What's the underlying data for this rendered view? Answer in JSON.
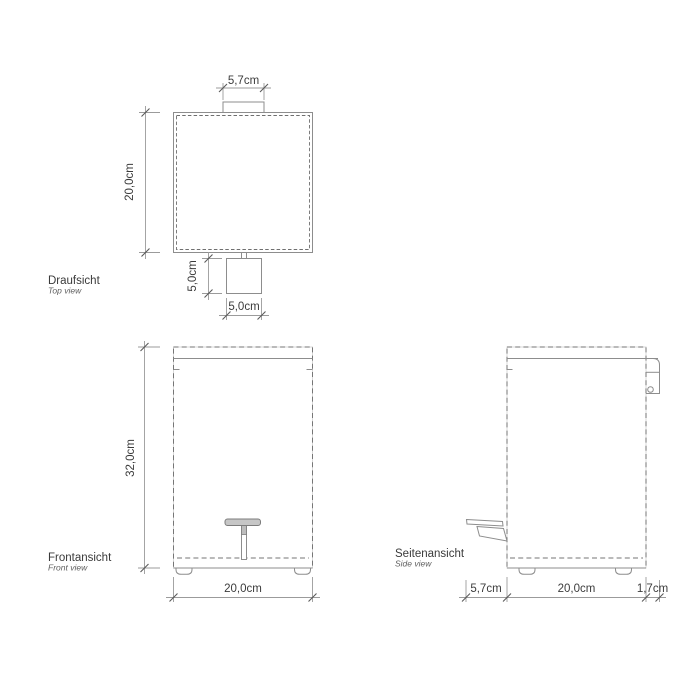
{
  "drawing": {
    "background": "#ffffff",
    "line_color": "#8d8d8d",
    "dim_line_color": "#9b9b9b",
    "text_color": "#3c3c3c",
    "pedal_fill_color": "#c6c6c6",
    "views": {
      "top": {
        "label": "Draufsicht",
        "sublabel": "Top view",
        "dims": {
          "lid_knob_width": "5,7cm",
          "body_depth": "20,0cm",
          "pedal_depth": "5,0cm",
          "pedal_width": "5,0cm"
        }
      },
      "front": {
        "label": "Frontansicht",
        "sublabel": "Front view",
        "dims": {
          "body_height": "32,0cm",
          "body_width": "20,0cm"
        }
      },
      "side": {
        "label": "Seitenansicht",
        "sublabel": "Side view",
        "dims": {
          "pedal_protrusion": "5,7cm",
          "body_depth": "20,0cm",
          "wall_offset": "1,7cm"
        }
      }
    }
  }
}
